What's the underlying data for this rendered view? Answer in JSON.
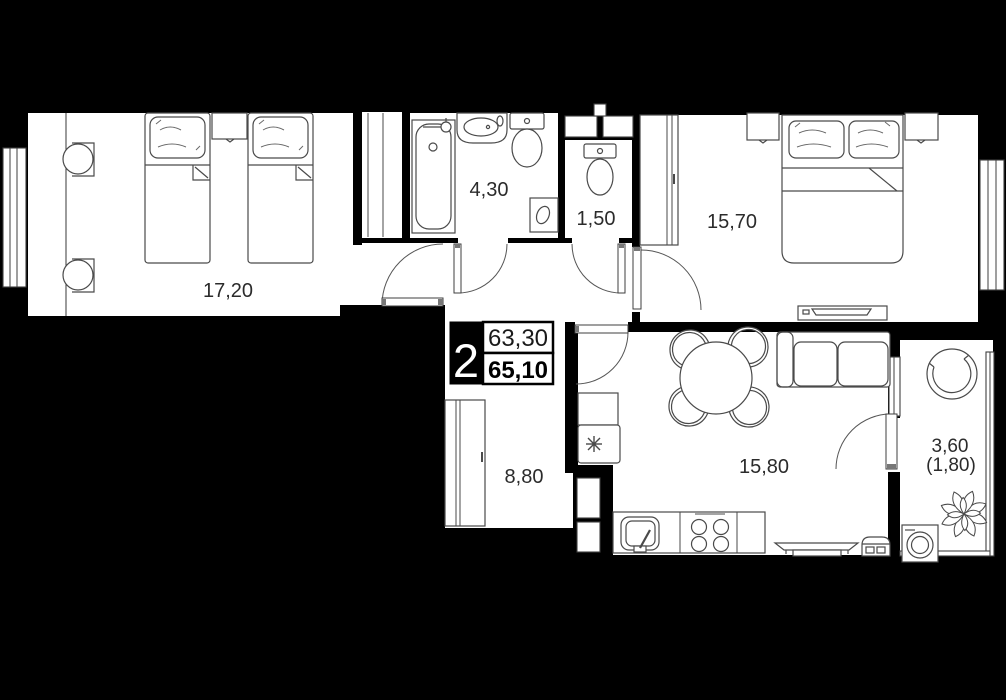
{
  "plan": {
    "type": "apartment-floor-plan",
    "badge": {
      "rooms_count": "2",
      "area_top": "63,30",
      "area_bottom": "65,10"
    },
    "rooms": [
      {
        "name": "bedroom-twin",
        "area": "17,20"
      },
      {
        "name": "bathroom",
        "area": "4,30"
      },
      {
        "name": "toilet",
        "area": "1,50"
      },
      {
        "name": "bedroom-master",
        "area": "15,70"
      },
      {
        "name": "hallway",
        "area": "8,80"
      },
      {
        "name": "kitchen-living",
        "area": "15,80"
      },
      {
        "name": "balcony",
        "area": "3,60",
        "area_reduced": "(1,80)"
      }
    ],
    "colors": {
      "background": "#000000",
      "floor": "#ffffff",
      "walls": "#000000",
      "furniture_line": "#4a4a4a",
      "label_text": "#2b2b2b",
      "badge_bg": "#000000",
      "badge_text": "#ffffff"
    },
    "icons": {
      "fridge": "snowflake-asterisk-icon",
      "plant": "flower-rosette-icon",
      "doors": "quarter-arc-swing-icon"
    },
    "furniture": {
      "bedroom_twin": [
        "single-bed",
        "single-bed",
        "nightstand",
        "desk",
        "desk-chair",
        "desk-chair",
        "window",
        "closet"
      ],
      "bathroom": [
        "bathtub",
        "washbasin",
        "toilet",
        "water-heater"
      ],
      "toilet": [
        "toilet",
        "vent-shaft",
        "vent-shaft"
      ],
      "bedroom_master": [
        "wardrobe",
        "nightstand",
        "double-bed",
        "nightstand",
        "tv-desk",
        "window"
      ],
      "hallway": [
        "wardrobe",
        "entrance-door"
      ],
      "kitchen_living": [
        "cabinet",
        "fridge",
        "vent-shaft",
        "sink",
        "stove",
        "counter",
        "dining-table",
        "chair",
        "chair",
        "chair",
        "chair",
        "sofa",
        "tv",
        "media-unit"
      ],
      "balcony": [
        "round-chair",
        "plant",
        "washing-machine",
        "glazing"
      ]
    }
  }
}
